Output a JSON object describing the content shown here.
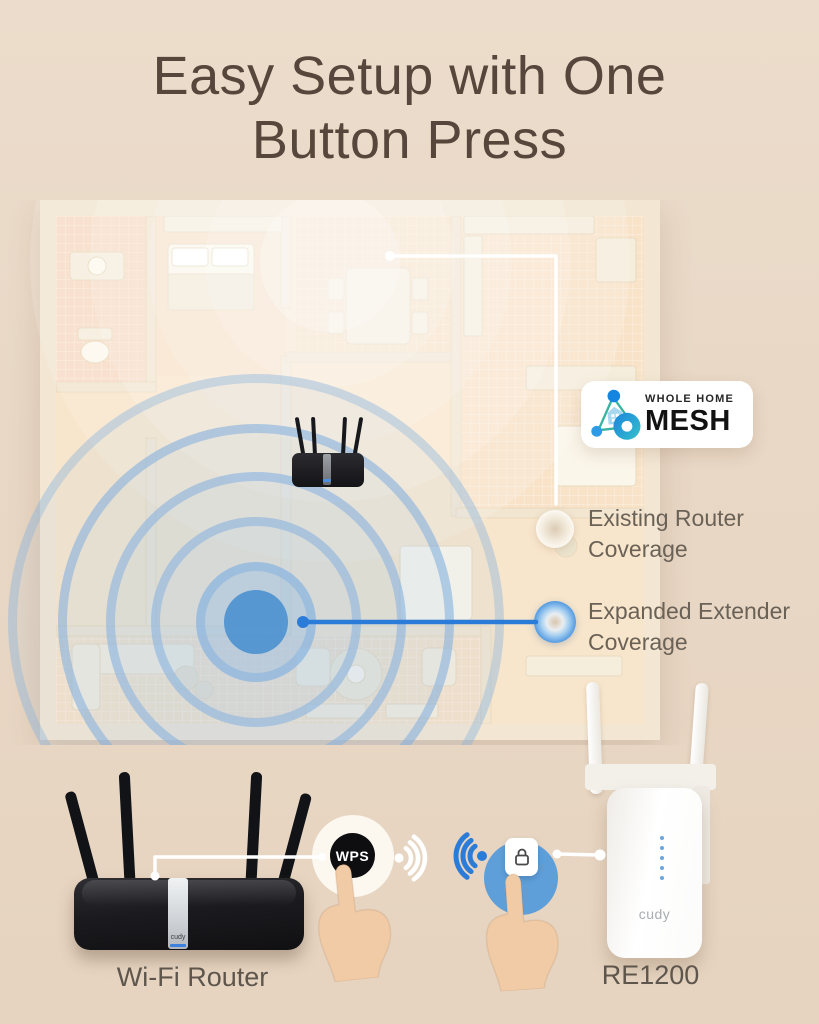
{
  "title": {
    "line1": "Easy Setup with One",
    "line2": "Button Press"
  },
  "mesh_badge": {
    "top": "WHOLE HOME",
    "bottom": "MESH"
  },
  "legend": {
    "existing": {
      "line1": "Existing Router",
      "line2": "Coverage"
    },
    "expanded": {
      "line1": "Expanded Extender",
      "line2": "Coverage"
    }
  },
  "devices": {
    "router": {
      "label": "Wi-Fi Router",
      "brand": "cudy"
    },
    "extender": {
      "label": "RE1200",
      "brand": "cudy"
    }
  },
  "buttons": {
    "wps": "WPS"
  },
  "colors": {
    "background": "#e8d7c4",
    "title_text": "#56463b",
    "label_text": "#5e564c",
    "accent_blue": "#2b7cd8",
    "coverage_blue": "#5f9fd9",
    "wps_black": "#0e0e10",
    "badge_bg": "#ffffff"
  }
}
